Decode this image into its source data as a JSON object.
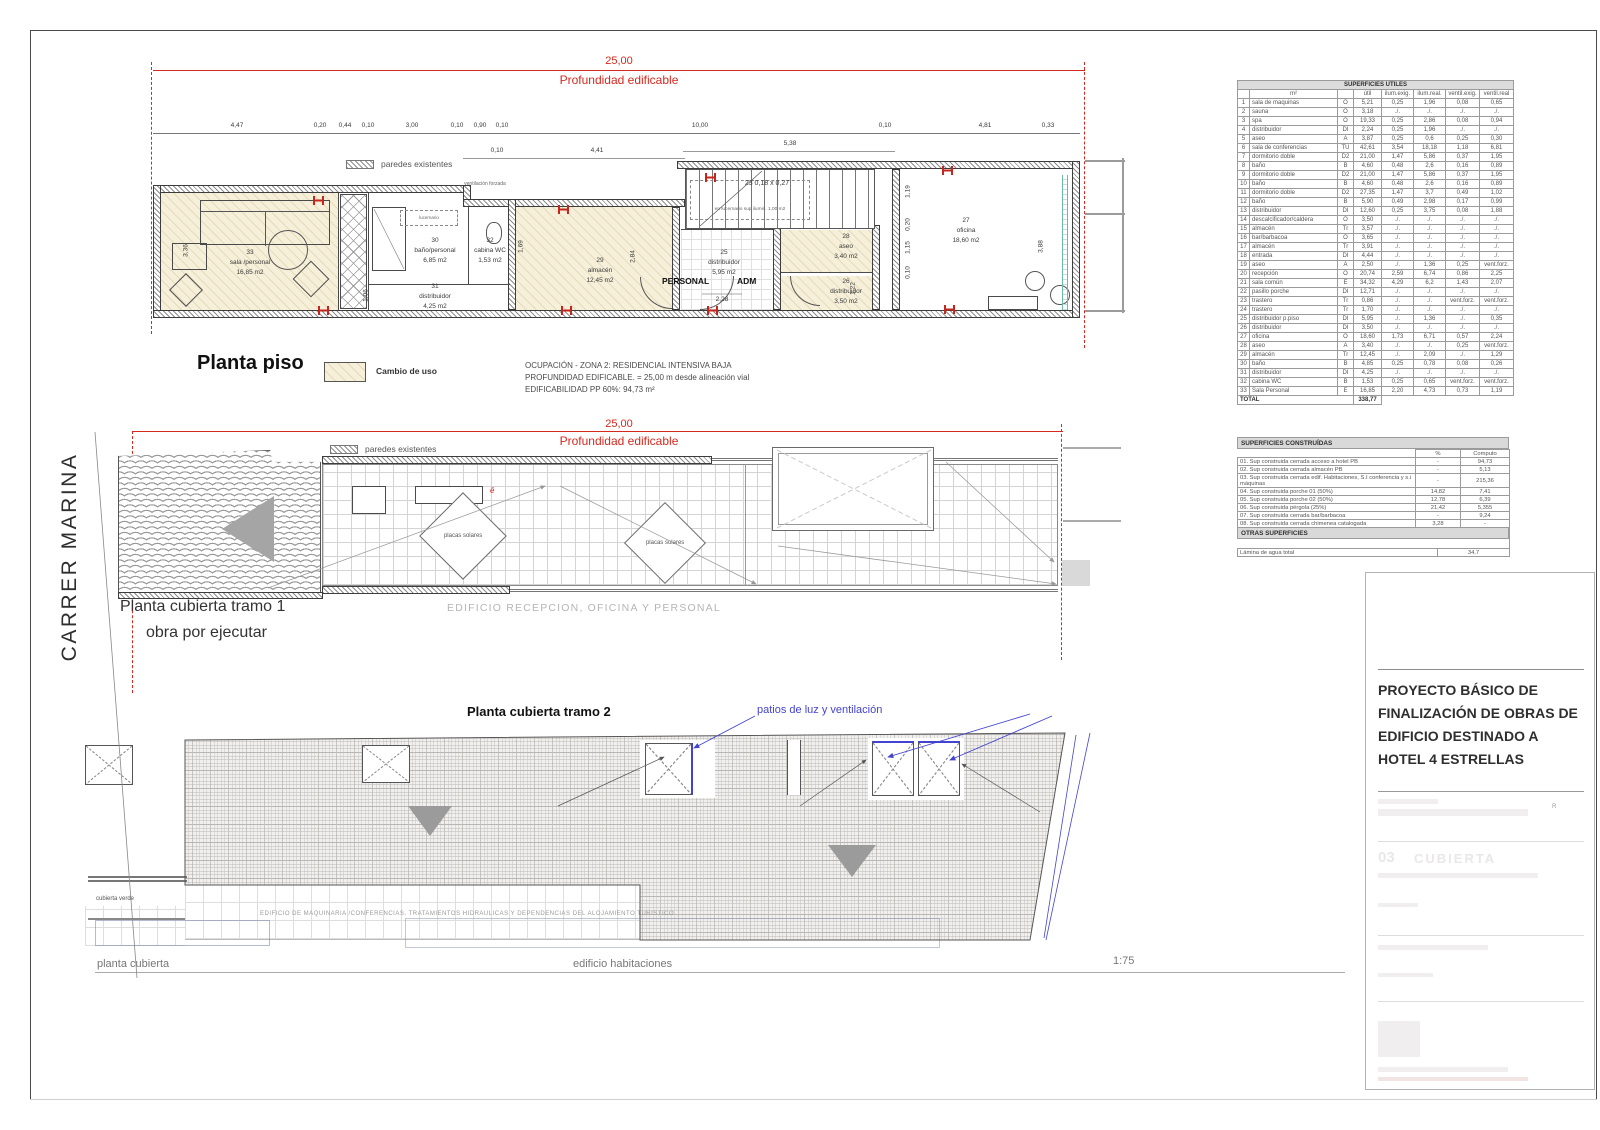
{
  "colors": {
    "accent_red": "#d6281e",
    "annotation_blue": "#4343cf",
    "cambio_uso_beige": "#f6f0da"
  },
  "street_label": "CARRER MARINA",
  "scale_label": "1:75",
  "piso": {
    "title": "Planta piso",
    "red_dim": "25,00",
    "red_dim_label": "Profundidad edificable",
    "legend_walls": "paredes existentes",
    "legend_change": "Cambio de uso",
    "notes": [
      "OCUPACIÓN - ZONA 2: RESIDENCIAL INTENSIVA BAJA",
      "PROFUNDIDAD EDIFICABLE. = 25,00 m desde alineación vial",
      "EDIFICABILIDAD PP 60%: 94,73 m²"
    ],
    "dims_top": [
      "4,47",
      "0,20",
      "0,44",
      "0,10",
      "3,00",
      "0,10",
      "0,90",
      "0,10",
      "10,00",
      "0,10",
      "4,81",
      "0,33"
    ],
    "dims_mid": [
      "0,10",
      "4,41",
      "5,38"
    ],
    "dims_vert": [
      "3,36",
      "1,06",
      "1,69",
      "2,84",
      "1,22",
      "3,88",
      "1,19",
      "0,20",
      "1,15",
      "0,10"
    ],
    "vent_label": "ventilación forzada",
    "lucernario_label": "lucernario",
    "stair_note1": "23  0,18 x 0,27",
    "stair_note2": "en lucernario sup ilumin. 1,00 m2",
    "personal_label": "PERSONAL",
    "adm_label": "ADM",
    "dim_door": "2,28",
    "rooms": [
      {
        "num": "33",
        "name": "sala /personal",
        "area": "16,85 m2"
      },
      {
        "num": "30",
        "name": "baño/personal",
        "area": "6,85 m2"
      },
      {
        "num": "32",
        "name": "cabina WC",
        "area": "1,53 m2"
      },
      {
        "num": "31",
        "name": "distribuidor",
        "area": "4,25 m2"
      },
      {
        "num": "29",
        "name": "almacén",
        "area": "12,45 m2"
      },
      {
        "num": "25",
        "name": "distribuidor",
        "area": "5,95 m2"
      },
      {
        "num": "28",
        "name": "aseo",
        "area": "3,40 m2"
      },
      {
        "num": "26",
        "name": "distribuidor",
        "area": "3,50 m2"
      },
      {
        "num": "27",
        "name": "oficina",
        "area": "18,60 m2"
      }
    ]
  },
  "tramo1": {
    "red_dim": "25,00",
    "red_dim_label": "Profundidad edificable",
    "legend_walls": "paredes existentes",
    "title": "Planta cubierta tramo 1",
    "subtitle": "obra por ejecutar",
    "caption": "EDIFICIO RECEPCION, OFICINA Y PERSONAL",
    "solar1": "placas solares",
    "solar2": "placas solares"
  },
  "tramo2": {
    "title": "Planta cubierta tramo 2",
    "patios_label": "patios de luz y ventilación",
    "green_roof_label": "cubierta verde",
    "caption": "EDIFICIO DE MAQUINARIA /CONFERENCIAS. TRATAMIENTOS HIDRAULICAS Y DEPENDENCIAS DEL ALOJAMIENTO TURISTICO",
    "label_left": "planta cubierta",
    "label_right": "edificio habitaciones"
  },
  "tables": {
    "utiles": {
      "title": "SUPERFICIES UTILES",
      "header_m2": "m²",
      "headers": [
        "útil",
        "ilum.exig.",
        "ilum.real.",
        "ventil.exig.",
        "ventil.real"
      ],
      "rows": [
        [
          "1",
          "sala de maquinas",
          "O",
          "5,21",
          "0,25",
          "1,96",
          "0,08",
          "0,65"
        ],
        [
          "2",
          "sauna",
          "O",
          "3,18",
          "./.",
          "./.",
          "./.",
          "./."
        ],
        [
          "3",
          "spa",
          "O",
          "19,33",
          "0,25",
          "2,86",
          "0,08",
          "0,94"
        ],
        [
          "4",
          "distribuidor",
          "DI",
          "2,24",
          "0,25",
          "1,96",
          "./.",
          "./."
        ],
        [
          "5",
          "aseo",
          "A",
          "3,87",
          "0,25",
          "0,6",
          "0,25",
          "0,30"
        ],
        [
          "6",
          "sala de conferencias",
          "TU",
          "42,61",
          "3,54",
          "18,18",
          "1,18",
          "6,81"
        ],
        [
          "7",
          "dormitorio doble",
          "D2",
          "21,00",
          "1,47",
          "5,86",
          "0,37",
          "1,95"
        ],
        [
          "8",
          "baño",
          "B",
          "4,60",
          "0,48",
          "2,6",
          "0,16",
          "0,89"
        ],
        [
          "9",
          "dormitorio doble",
          "D2",
          "21,00",
          "1,47",
          "5,86",
          "0,37",
          "1,95"
        ],
        [
          "10",
          "baño",
          "B",
          "4,60",
          "0,48",
          "2,6",
          "0,16",
          "0,89"
        ],
        [
          "11",
          "dormitorio doble",
          "D2",
          "27,35",
          "1,47",
          "3,7",
          "0,49",
          "1,02"
        ],
        [
          "12",
          "baño",
          "B",
          "5,90",
          "0,49",
          "2,98",
          "0,17",
          "0,99"
        ],
        [
          "13",
          "distribuidor",
          "DI",
          "12,60",
          "0,25",
          "3,75",
          "0,08",
          "1,88"
        ],
        [
          "14",
          "descalcificador/caldera",
          "O",
          "3,50",
          "./.",
          "./.",
          "./.",
          "./."
        ],
        [
          "15",
          "almacén",
          "Tr",
          "3,57",
          "./.",
          "./.",
          "./.",
          "./."
        ],
        [
          "16",
          "bar/barbacoa",
          "O",
          "3,65",
          "./.",
          "./.",
          "./.",
          "./."
        ],
        [
          "17",
          "almacén",
          "Tr",
          "3,91",
          "./.",
          "./.",
          "./.",
          "./."
        ],
        [
          "18",
          "entrada",
          "DI",
          "4,44",
          "./.",
          "./.",
          "./.",
          "./."
        ],
        [
          "19",
          "aseo",
          "A",
          "2,50",
          "./.",
          "1,36",
          "0,25",
          "vent.forz."
        ],
        [
          "20",
          "recepción",
          "O",
          "20,74",
          "2,59",
          "6,74",
          "0,86",
          "2,25"
        ],
        [
          "21",
          "sala común",
          "E",
          "34,32",
          "4,29",
          "6,2",
          "1,43",
          "2,07"
        ],
        [
          "22",
          "pasillo porche",
          "DI",
          "12,71",
          "./.",
          "./.",
          "./.",
          "./."
        ],
        [
          "23",
          "trastero",
          "Tr",
          "0,86",
          "./.",
          "./.",
          "vent.forz.",
          "vent.forz."
        ],
        [
          "24",
          "trastero",
          "Tr",
          "1,70",
          "./.",
          "./.",
          "./.",
          "./."
        ],
        [
          "25",
          "distribuidor p.piso",
          "DI",
          "5,95",
          "./.",
          "1,36",
          "./.",
          "0,35"
        ],
        [
          "26",
          "distribuidor",
          "DI",
          "3,50",
          "./.",
          "./.",
          "./.",
          "./."
        ],
        [
          "27",
          "oficina",
          "O",
          "18,60",
          "1,73",
          "6,71",
          "0,57",
          "2,24"
        ],
        [
          "28",
          "aseo",
          "A",
          "3,40",
          "./.",
          "./.",
          "0,25",
          "vent.forz."
        ],
        [
          "29",
          "almacén",
          "Tr",
          "12,45",
          "./.",
          "2,09",
          "./.",
          "1,29"
        ],
        [
          "30",
          "baño",
          "B",
          "4,85",
          "0,25",
          "0,78",
          "0,08",
          "0,26"
        ],
        [
          "31",
          "distribuidor",
          "DI",
          "4,25",
          "./.",
          "./.",
          "./.",
          "./."
        ],
        [
          "32",
          "cabina WC",
          "B",
          "1,53",
          "0,25",
          "0,65",
          "vent.forz.",
          "vent.forz."
        ],
        [
          "33",
          "Sala Personal",
          "E",
          "16,85",
          "2,20",
          "4,73",
          "0,73",
          "1,19"
        ]
      ],
      "total_label": "TOTAL",
      "total_value": "338,77"
    },
    "construidas": {
      "title": "SUPERFICIES CONSTRUÍDAS",
      "col_pct": "%",
      "col_computo": "Computo",
      "rows": [
        {
          "name": "01. Sup construida cerrada acceso a hotel PB",
          "pct": "-",
          "comp": "94,73"
        },
        {
          "name": "02. Sup construida cerrada almacén PB",
          "pct": "-",
          "comp": "5,13"
        },
        {
          "name": "03. Sup construida cerrada  edif. Habitaciones, S.I conferencia y s.i máquinas",
          "pct": "-",
          "comp": "215,36"
        },
        {
          "name": "04. Sup construida porche 01 (50%)",
          "pct": "14,82",
          "comp": "7,41"
        },
        {
          "name": "05. Sup construida porche 02 (50%)",
          "pct": "12,78",
          "comp": "6,39"
        },
        {
          "name": "06. Sup construida pérgola (25%)",
          "pct": "21,42",
          "comp": "5,355"
        },
        {
          "name": "07. Sup construida cerrada bar/barbacoa",
          "pct": "-",
          "comp": "9,24"
        },
        {
          "name": "08. Sup construida cerrada chimenea catalogada",
          "pct": "3,28",
          "comp": "-"
        },
        {
          "name": "09. Sup. Construida piscina/lum",
          "pct": "54,34",
          "comp": "-"
        },
        {
          "name": "10. Sup. Construida cerrada zona adm. Hotel PP",
          "pct": "-",
          "comp": "94,73"
        }
      ],
      "total_label": "SUPERFICIE CONSTRUÍDA TOTAL",
      "total_value": "438,35"
    },
    "otras": {
      "title": "OTRAS SUPERFICIES",
      "rows": [
        {
          "name": "Lámina de agua total",
          "value": "34,7"
        }
      ]
    }
  },
  "title_block": {
    "project_title": "PROYECTO BÁSICO DE FINALIZACIÓN DE OBRAS DE EDIFICIO DESTINADO A HOTEL 4 ESTRELLAS",
    "faint_number": "03",
    "faint_word": "CUBIERTA"
  }
}
